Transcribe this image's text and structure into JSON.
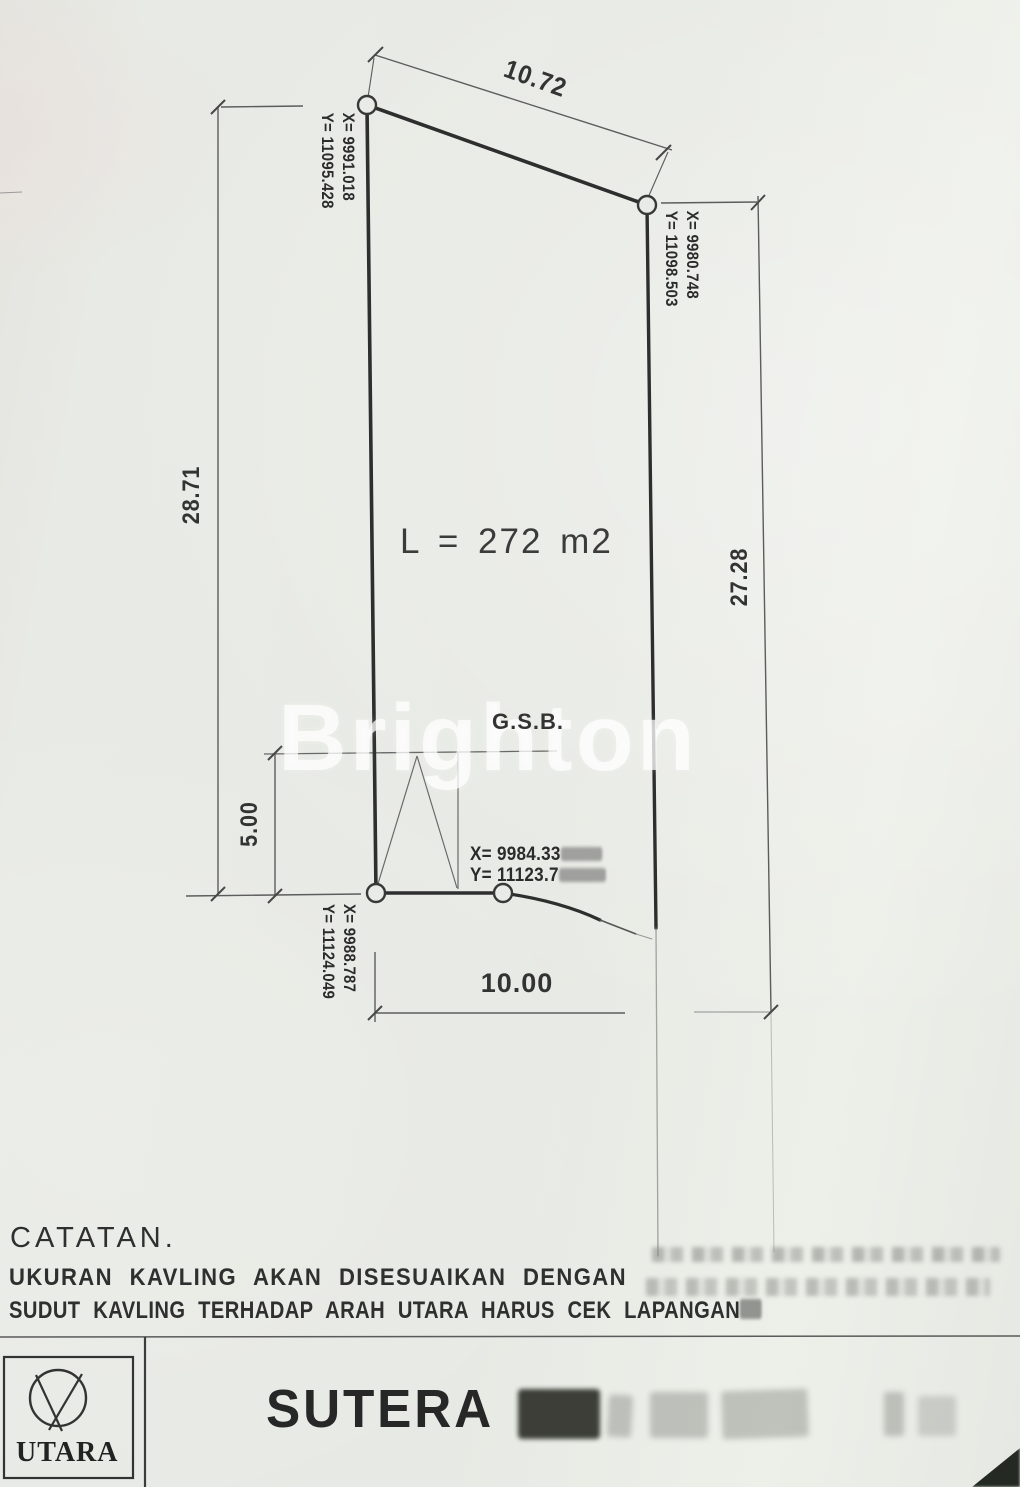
{
  "drawing": {
    "dimensions": {
      "top": "10.72",
      "left": "28.71",
      "right": "27.28",
      "gsb_offset": "5.00",
      "bottom": "10.00"
    },
    "area_label": "L = 272 m2",
    "gsb_label": "G.S.B.",
    "corners": {
      "top_left": {
        "x": "X= 9991.018",
        "y": "Y= 11095.428"
      },
      "top_right": {
        "x": "X= 9980.748",
        "y": "Y= 11098.503"
      },
      "bottom_left": {
        "x": "X= 9988.787",
        "y": "Y= 11124.049"
      },
      "bottom_mid": {
        "x": "X= 9984.33",
        "y": "Y= 11123.7"
      }
    },
    "watermark": "Brighton"
  },
  "notes": {
    "heading": "CATATAN.",
    "line1": "UKURAN KAVLING AKAN DISESUAIKAN DENGAN",
    "line2": "SUDUT KAVLING TERHADAP ARAH UTARA HARUS CEK LAPANGAN"
  },
  "title_block": {
    "north_label": "UTARA",
    "project_title": "SUTERA"
  },
  "colors": {
    "paper": "#e8eae5",
    "boundary_line": "#2e2e2e",
    "dim_line": "#5c5c5c",
    "text": "#2e2e2e"
  }
}
